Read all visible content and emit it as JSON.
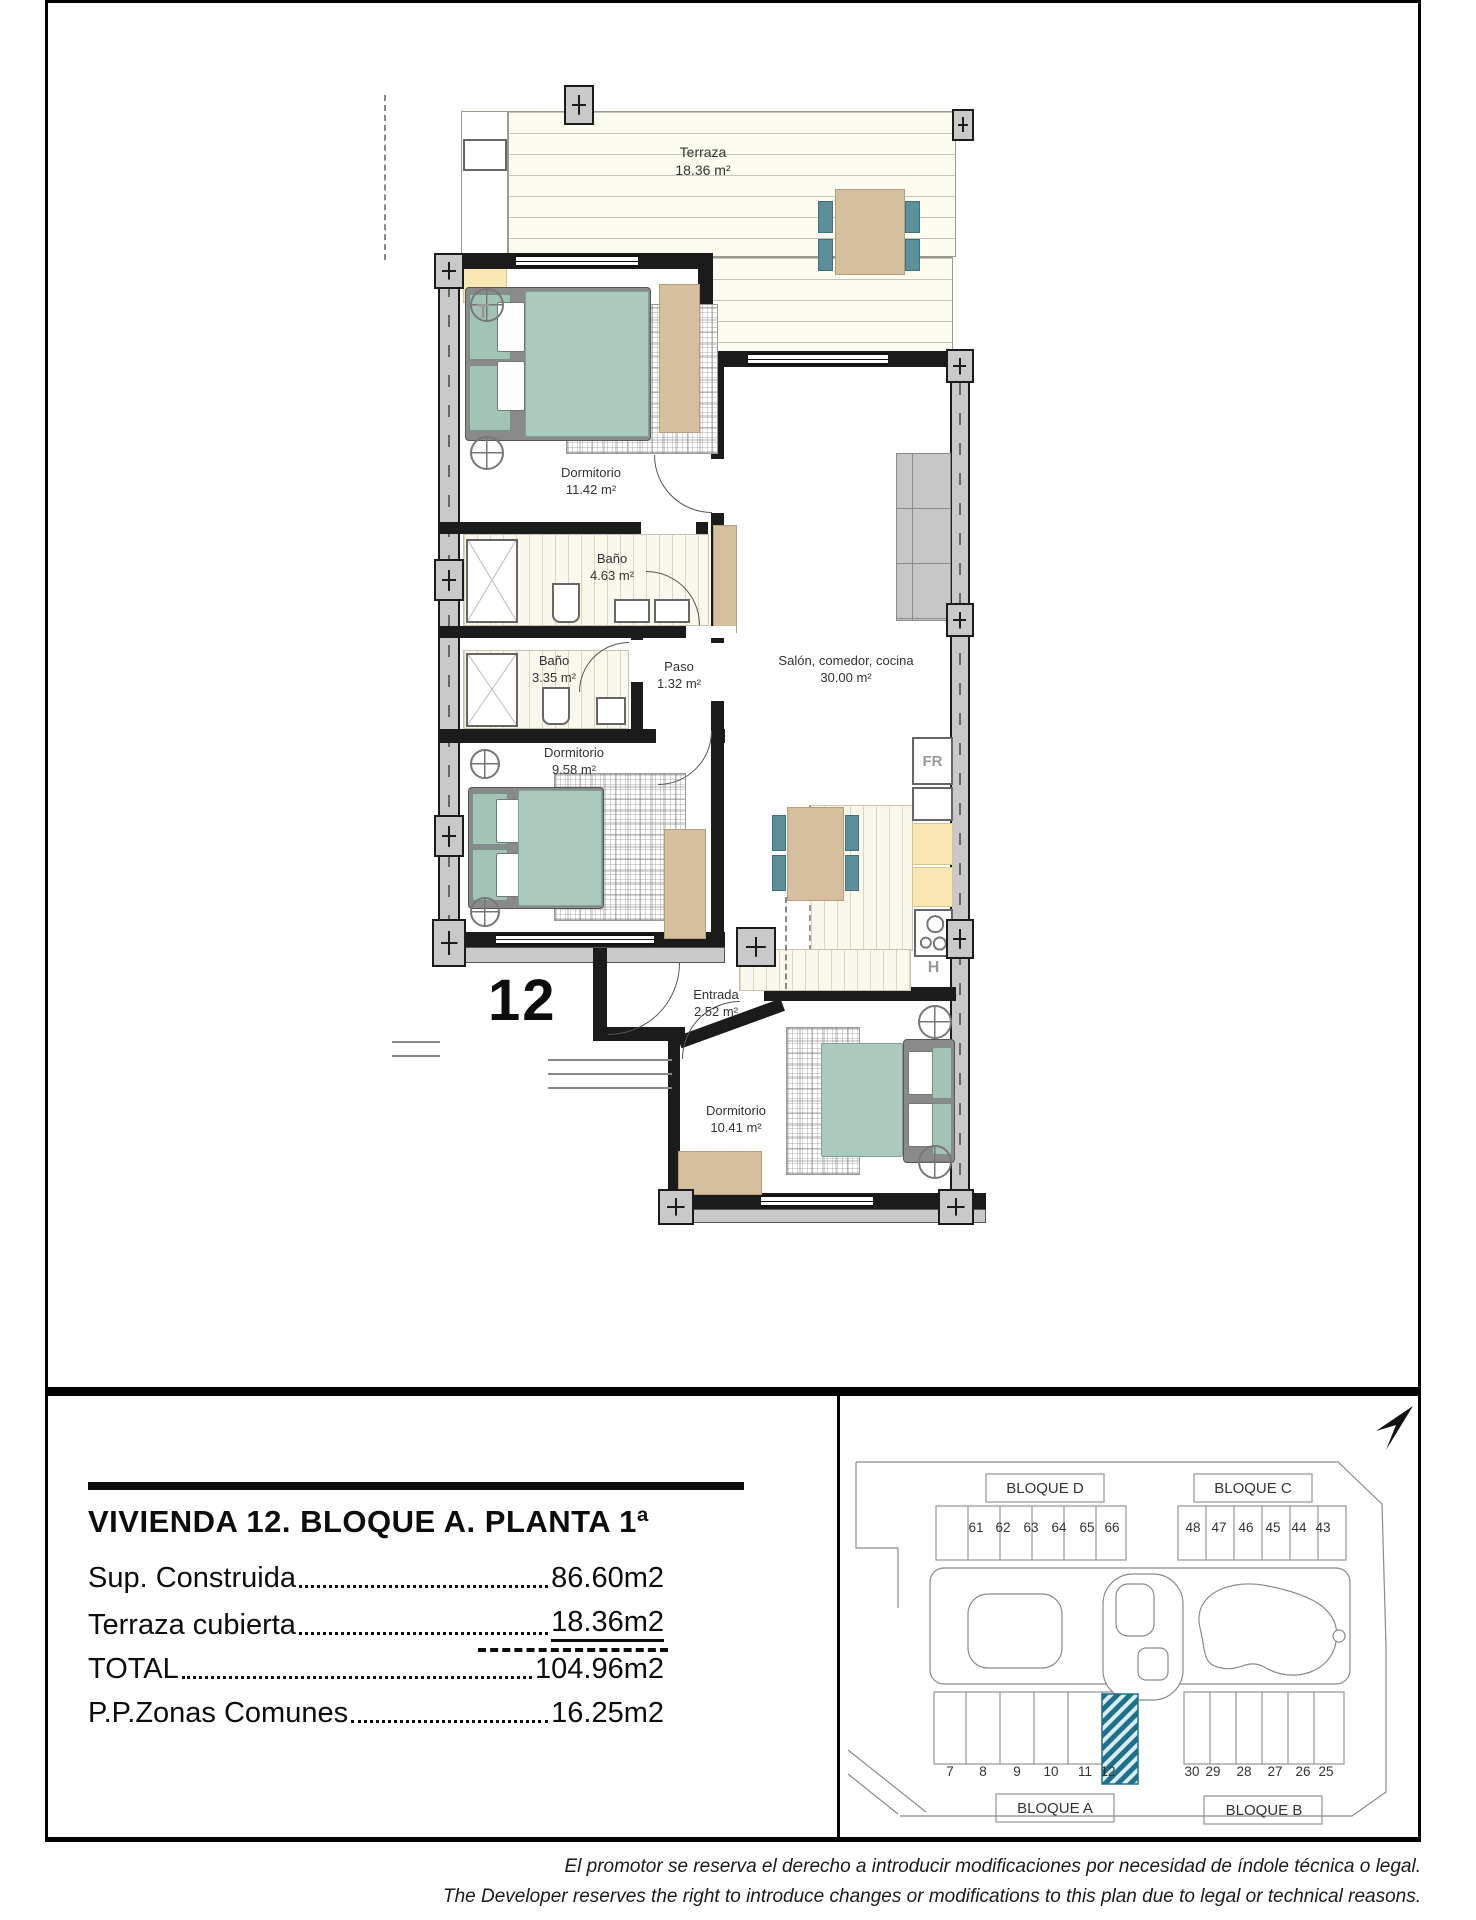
{
  "floor_plan": {
    "unit_number": "12",
    "terrace_letter": "T",
    "fridge_label": "FR",
    "hob_label": "H",
    "rooms": [
      {
        "name": "Terraza",
        "area": "18.36 m²"
      },
      {
        "name": "Dormitorio",
        "area": "11.42 m²"
      },
      {
        "name": "Baño",
        "area": "4.63 m²"
      },
      {
        "name": "Baño",
        "area": "3.35 m²"
      },
      {
        "name": "Paso",
        "area": "1.32 m²"
      },
      {
        "name": "Salón, comedor, cocina",
        "area": "30.00 m²"
      },
      {
        "name": "Dormitorio",
        "area": "9.58 m²"
      },
      {
        "name": "Entrada",
        "area": "2.52 m²"
      },
      {
        "name": "Dormitorio",
        "area": "10.41 m²"
      }
    ]
  },
  "title_block": {
    "title": "VIVIENDA 12. BLOQUE A. PLANTA 1ª",
    "rows": [
      {
        "label": "Sup. Construida",
        "value": "86.60m2"
      },
      {
        "label": "Terraza cubierta",
        "value": "18.36m2"
      },
      {
        "label": "TOTAL",
        "value": "104.96m2"
      },
      {
        "label": "P.P.Zonas Comunes",
        "value": "16.25m2"
      }
    ]
  },
  "site_plan": {
    "highlighted_unit": "12",
    "blocks": [
      {
        "label": "BLOQUE D",
        "units": [
          "61",
          "62",
          "63",
          "64",
          "65",
          "66"
        ]
      },
      {
        "label": "BLOQUE C",
        "units": [
          "48",
          "47",
          "46",
          "45",
          "44",
          "43"
        ]
      },
      {
        "label": "BLOQUE A",
        "units": [
          "7",
          "8",
          "9",
          "10",
          "11",
          "12"
        ]
      },
      {
        "label": "BLOQUE B",
        "units": [
          "30",
          "29",
          "28",
          "27",
          "26",
          "25"
        ]
      }
    ]
  },
  "footer": {
    "line_es": "El promotor se reserva el derecho a introducir modificaciones por necesidad de índole técnica o legal.",
    "line_en": "The Developer reserves the right to introduce changes or modifications to this plan due to legal or technical reasons."
  },
  "colors": {
    "hatch_teal": "#1f7088",
    "furniture_teal": "#5d8f99",
    "bed_teal": "#abc9bc",
    "wood_tan": "#d5bf9e",
    "counter_yellow": "#f9e8b4",
    "wall_gray": "#c9c9c9"
  }
}
